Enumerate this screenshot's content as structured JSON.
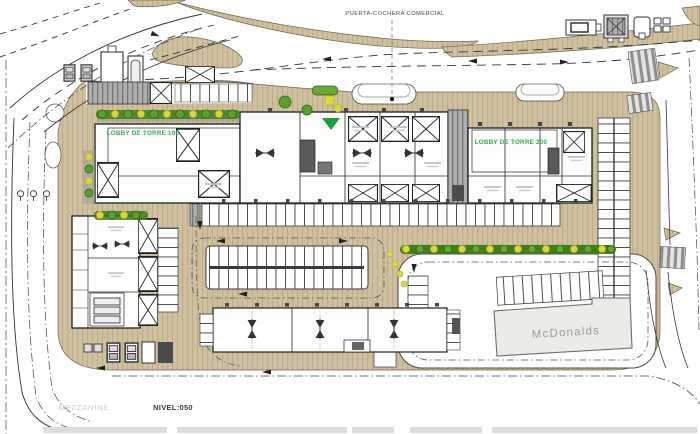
{
  "drawing": {
    "type": "architectural-site-plan",
    "level_label": "NIVEL:050",
    "sheet_tab_label": "MEZZANINE",
    "labels": {
      "puerta_cochera": "PUERTA-COCHERA COMERCIAL",
      "lobby_torre_100": "LOBBY DE TORRE 100",
      "lobby_torre_200": "LOBBY DE TORRE 200",
      "mcdonalds": "McDonalds",
      "mezzanine": "MEZZANINE",
      "nivel": "NIVEL:050"
    },
    "colors": {
      "sidewalk_tan": "#cfc1a0",
      "sidewalk_hatch": "#b9a882",
      "lobby_label_green": "#2fae4a",
      "landscape_green": "#58a22c",
      "landscape_dark_green": "#3f7d1d",
      "landscape_yellow": "#d9d73e",
      "pavement_gray": "#a8a8a8",
      "line_black": "#2b2b2b",
      "mcdonalds_fill": "#ebebe8",
      "mcdonalds_text_gray": "#9b9b9b",
      "mezzanine_text_gray": "#cbcbc8",
      "nivel_text_dark": "#3a3a3a"
    }
  }
}
